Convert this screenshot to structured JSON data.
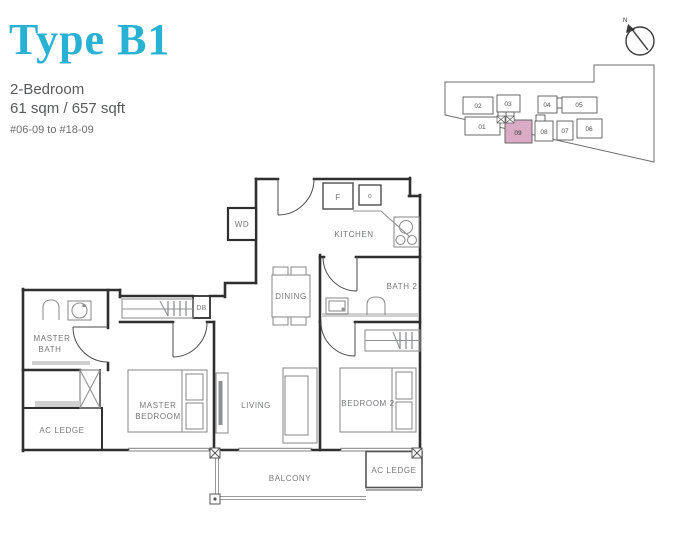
{
  "header": {
    "title": "Type B1",
    "subtitle": "2-Bedroom",
    "area": "61 sqm / 657 sqft",
    "units_range": "#06-09 to #18-09"
  },
  "colors": {
    "accent": "#29b1d4",
    "text_gray": "#58595b",
    "wall": "#2f2f2f",
    "fixture_gray": "#8f9092",
    "highlight_pink": "#d9abc5"
  },
  "key_plan": {
    "north_label": "N",
    "highlighted_unit": "09",
    "units": [
      {
        "label": "02"
      },
      {
        "label": "03"
      },
      {
        "label": "04"
      },
      {
        "label": "05"
      },
      {
        "label": "01"
      },
      {
        "label": "09"
      },
      {
        "label": "08"
      },
      {
        "label": "07"
      },
      {
        "label": "06"
      }
    ]
  },
  "floor_plan": {
    "labels": {
      "wd": "WD",
      "kitchen": "KITCHEN",
      "fridge": "F",
      "oven": "o",
      "dining": "DINING",
      "bath2": "BATH 2",
      "db": "DB",
      "master_bath_l1": "MASTER",
      "master_bath_l2": "BATH",
      "master_bedroom_l1": "MASTER",
      "master_bedroom_l2": "BEDROOM",
      "living": "LIVING",
      "bedroom2": "BEDROOM 2",
      "balcony": "BALCONY",
      "ac_ledge_left": "AC LEDGE",
      "ac_ledge_right": "AC LEDGE"
    }
  }
}
